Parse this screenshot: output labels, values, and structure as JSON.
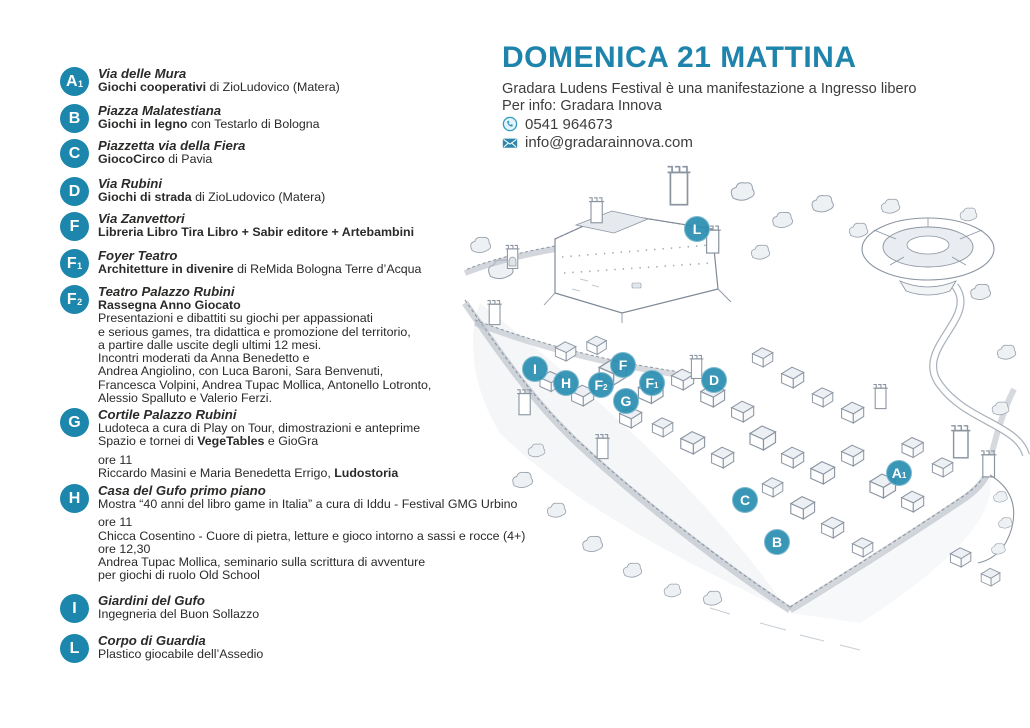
{
  "accent_color": "#1c86ac",
  "marker_color": "#298db1",
  "header": {
    "title": "DOMENICA 21 MATTINA",
    "line1": "Gradara Ludens Festival è una manifestazione a Ingresso libero",
    "line2": "Per info: Gradara Innova",
    "phone_icon": "phone-icon",
    "email_icon": "email-icon",
    "phone": "0541 964673",
    "email": "info@gradarainnova.com"
  },
  "legend": {
    "items": [
      {
        "badge": "A",
        "badge_sub": "1",
        "venue": "Via delle Mura",
        "lines": [
          {
            "segments": [
              {
                "text": "Giochi cooperativi",
                "bold": true
              },
              {
                "text": " di ZioLudovico (Matera)",
                "bold": false
              }
            ]
          }
        ]
      },
      {
        "badge": "B",
        "badge_sub": "",
        "venue": "Piazza Malatestiana",
        "lines": [
          {
            "segments": [
              {
                "text": "Giochi in legno",
                "bold": true
              },
              {
                "text": " con Testarlo di Bologna",
                "bold": false
              }
            ]
          }
        ]
      },
      {
        "badge": "C",
        "badge_sub": "",
        "venue": "Piazzetta via della Fiera",
        "lines": [
          {
            "segments": [
              {
                "text": "GiocoCirco",
                "bold": true
              },
              {
                "text": " di Pavia",
                "bold": false
              }
            ]
          }
        ]
      },
      {
        "badge": "D",
        "badge_sub": "",
        "venue": "Via Rubini",
        "lines": [
          {
            "segments": [
              {
                "text": "Giochi di strada",
                "bold": true
              },
              {
                "text": " di ZioLudovico (Matera)",
                "bold": false
              }
            ]
          }
        ]
      },
      {
        "badge": "F",
        "badge_sub": "",
        "venue": "Via Zanvettori",
        "lines": [
          {
            "segments": [
              {
                "text": "Libreria Libro Tira Libro + Sabir editore + Artebambini",
                "bold": true
              }
            ]
          }
        ]
      },
      {
        "badge": "F",
        "badge_sub": "1",
        "venue": "Foyer Teatro",
        "lines": [
          {
            "segments": [
              {
                "text": "Architetture in divenire",
                "bold": true
              },
              {
                "text": " di ReMida Bologna Terre d’Acqua",
                "bold": false
              }
            ]
          }
        ]
      },
      {
        "badge": "F",
        "badge_sub": "2",
        "venue": "Teatro Palazzo Rubini",
        "lines": [
          {
            "segments": [
              {
                "text": "Rassegna Anno Giocato",
                "bold": true
              }
            ]
          },
          {
            "segments": [
              {
                "text": "Presentazioni e dibattiti su giochi per appassionati",
                "bold": false
              }
            ]
          },
          {
            "segments": [
              {
                "text": "e serious games, tra didattica e promozione del territorio,",
                "bold": false
              }
            ]
          },
          {
            "segments": [
              {
                "text": "a partire dalle uscite degli ultimi 12 mesi.",
                "bold": false
              }
            ]
          },
          {
            "segments": [
              {
                "text": "Incontri moderati da Anna Benedetto e",
                "bold": false
              }
            ]
          },
          {
            "segments": [
              {
                "text": "Andrea Angiolino, con Luca Baroni, Sara Benvenuti,",
                "bold": false
              }
            ]
          },
          {
            "segments": [
              {
                "text": "Francesca Volpini, Andrea Tupac Mollica, Antonello Lotronto,",
                "bold": false
              }
            ]
          },
          {
            "segments": [
              {
                "text": "Alessio Spalluto e Valerio Ferzi.",
                "bold": false
              }
            ]
          }
        ]
      },
      {
        "badge": "G",
        "badge_sub": "",
        "venue": "Cortile Palazzo Rubini",
        "lines": [
          {
            "segments": [
              {
                "text": "Ludoteca a cura di Play on Tour, dimostrazioni e anteprime",
                "bold": false
              }
            ]
          },
          {
            "segments": [
              {
                "text": "Spazio e tornei di ",
                "bold": false
              },
              {
                "text": "VegeTables",
                "bold": true
              },
              {
                "text": " e GioGra",
                "bold": false
              }
            ]
          },
          {
            "spacer": true,
            "segments": [
              {
                "text": "ore 11",
                "bold": false
              }
            ]
          },
          {
            "segments": [
              {
                "text": "Riccardo Masini e Maria Benedetta Errigo, ",
                "bold": false
              },
              {
                "text": "Ludostoria",
                "bold": true
              }
            ]
          }
        ]
      },
      {
        "badge": "H",
        "badge_sub": "",
        "venue": "Casa del Gufo primo piano",
        "lines": [
          {
            "segments": [
              {
                "text": "Mostra “40 anni del libro game in Italia” a cura di Iddu - Festival GMG Urbino",
                "bold": false
              }
            ]
          },
          {
            "spacer": true,
            "segments": [
              {
                "text": "ore 11",
                "bold": false
              }
            ]
          },
          {
            "segments": [
              {
                "text": "Chicca Cosentino - Cuore di pietra, letture e gioco intorno a sassi e rocce (4+)",
                "bold": false
              }
            ]
          },
          {
            "segments": [
              {
                "text": "ore 12,30",
                "bold": false
              }
            ]
          },
          {
            "segments": [
              {
                "text": "Andrea Tupac Mollica, seminario sulla scrittura di avventure",
                "bold": false
              }
            ]
          },
          {
            "segments": [
              {
                "text": "per giochi di ruolo Old School",
                "bold": false
              }
            ]
          }
        ]
      },
      {
        "badge": "I",
        "badge_sub": "",
        "venue": "Giardini del Gufo",
        "lines": [
          {
            "segments": [
              {
                "text": "Ingegneria del Buon Sollazzo",
                "bold": false
              }
            ]
          }
        ]
      },
      {
        "badge": "L",
        "badge_sub": "",
        "venue": "Corpo di Guardia",
        "lines": [
          {
            "segments": [
              {
                "text": "Plastico giocabile dell’Assedio",
                "bold": false
              }
            ]
          }
        ]
      }
    ]
  },
  "map": {
    "markers": [
      {
        "label": "L",
        "sub": "",
        "x": 697,
        "y": 229
      },
      {
        "label": "I",
        "sub": "",
        "x": 535,
        "y": 369
      },
      {
        "label": "H",
        "sub": "",
        "x": 566,
        "y": 383
      },
      {
        "label": "F",
        "sub": "2",
        "x": 601,
        "y": 385
      },
      {
        "label": "F",
        "sub": "",
        "x": 623,
        "y": 365
      },
      {
        "label": "G",
        "sub": "",
        "x": 626,
        "y": 401
      },
      {
        "label": "F",
        "sub": "1",
        "x": 652,
        "y": 383
      },
      {
        "label": "D",
        "sub": "",
        "x": 714,
        "y": 380
      },
      {
        "label": "A",
        "sub": "1",
        "x": 899,
        "y": 473
      },
      {
        "label": "C",
        "sub": "",
        "x": 745,
        "y": 500
      },
      {
        "label": "B",
        "sub": "",
        "x": 777,
        "y": 542
      }
    ]
  }
}
